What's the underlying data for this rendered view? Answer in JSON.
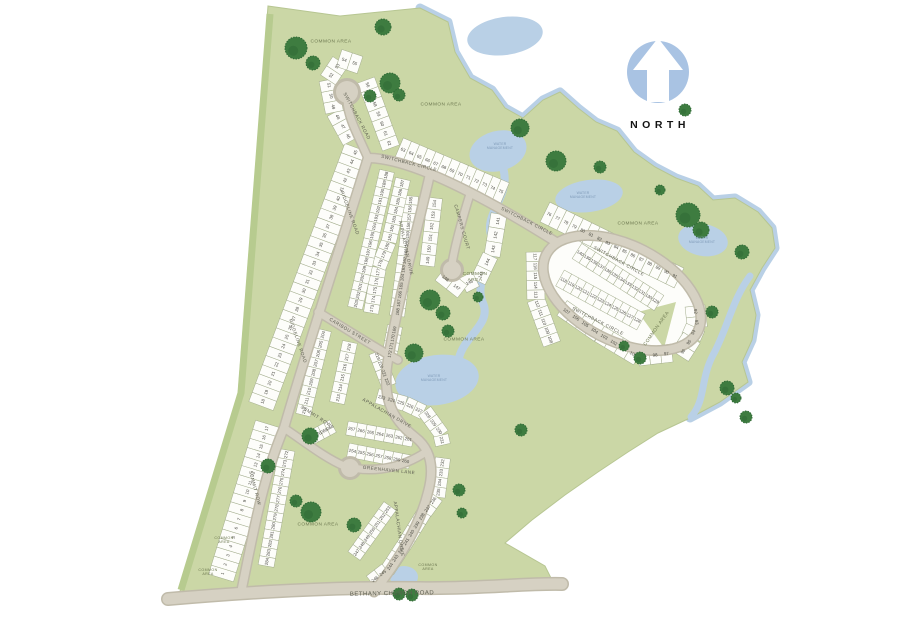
{
  "north_indicator": {
    "label": "NORTH"
  },
  "colors": {
    "site_green": "#cbd7a6",
    "site_green_dark": "#b7cb8f",
    "tree_green": "#3e7c40",
    "tree_green_dark": "#2f6a35",
    "water_blue": "#b9d0e6",
    "road_fill": "#d6d1c3",
    "road_casing": "#c0bbaa",
    "lot_fill": "#fdfdfa",
    "lot_outline": "#a3ad8d",
    "lot_number_grey": "#4a4a42",
    "street_label_grey": "#5c5d50",
    "area_label_green": "#6d7850",
    "water_label_blue": "#7f9ab8",
    "north_blue": "#a9c3e3"
  },
  "map_labels": {
    "street_labels": [
      {
        "text": "SWITCHBACK ROAD",
        "x": 357,
        "y": 116,
        "rot": 62
      },
      {
        "text": "SWITCHBACK CIRCLE",
        "x": 409,
        "y": 163,
        "rot": 14
      },
      {
        "text": "SWITCHBACK CIRCLE",
        "x": 527,
        "y": 221,
        "rot": 27
      },
      {
        "text": "SWITCHBACK CIRCLE",
        "x": 619,
        "y": 261,
        "rot": 29
      },
      {
        "text": "SWITCHBACK CIRCLE",
        "x": 598,
        "y": 321,
        "rot": 27
      },
      {
        "text": "CAMPERS COURT",
        "x": 462,
        "y": 227,
        "rot": 74
      },
      {
        "text": "RIDGELINE ROAD",
        "x": 350,
        "y": 213,
        "rot": 70
      },
      {
        "text": "RIDGELINE ROAD",
        "x": 298,
        "y": 341,
        "rot": 71
      },
      {
        "text": "APPALACHIAN DRIVE",
        "x": 406,
        "y": 248,
        "rot": 78
      },
      {
        "text": "APPALACHIAN DRIVE",
        "x": 387,
        "y": 413,
        "rot": 30
      },
      {
        "text": "APPALACHIAN DRIVE",
        "x": 399,
        "y": 529,
        "rot": 82
      },
      {
        "text": "CARIBOU STREET",
        "x": 350,
        "y": 331,
        "rot": 31
      },
      {
        "text": "SUMMIT ROW",
        "x": 316,
        "y": 416,
        "rot": 33
      },
      {
        "text": "SUMMIT ROW",
        "x": 255,
        "y": 488,
        "rot": 75
      },
      {
        "text": "GREENHAVEN LANE",
        "x": 389,
        "y": 470,
        "rot": 6
      },
      {
        "text": "BETHANY CHURCH ROAD",
        "x": 392,
        "y": 594,
        "rot": -1,
        "size": 6
      }
    ],
    "area_labels": [
      {
        "text": "COMMON AREA",
        "x": 331,
        "y": 42
      },
      {
        "text": "COMMON AREA",
        "x": 441,
        "y": 105
      },
      {
        "text": "COMMON AREA",
        "x": 638,
        "y": 224
      },
      {
        "text": "COMMON AREA",
        "x": 475,
        "y": 277,
        "two_line": true
      },
      {
        "text": "COMMON AREA",
        "x": 464,
        "y": 340
      },
      {
        "text": "COMMON AREA",
        "x": 657,
        "y": 329,
        "rot": -55
      },
      {
        "text": "COMMON AREA",
        "x": 318,
        "y": 525
      },
      {
        "text": "COMMON AREA",
        "x": 224,
        "y": 540,
        "two_line": true,
        "tiny": true
      },
      {
        "text": "COMMON AREA",
        "x": 208,
        "y": 572,
        "two_line": true,
        "tiny": true
      },
      {
        "text": "COMMON AREA",
        "x": 428,
        "y": 567,
        "two_line": true,
        "tiny": true
      }
    ],
    "water_labels": [
      {
        "text": "WATER MANAGEMENT",
        "x": 500,
        "y": 146
      },
      {
        "text": "WATER MANAGEMENT",
        "x": 583,
        "y": 195
      },
      {
        "text": "WATER MANAGEMENT",
        "x": 434,
        "y": 378
      },
      {
        "text": "WATER MANAGEMENT",
        "x": 702,
        "y": 240
      }
    ]
  },
  "lots": {
    "strips": [
      {
        "name": "lots-1-17",
        "start": 1,
        "end": 17,
        "depth": 26,
        "path": [
          [
            221,
            578
          ],
          [
            268,
            424
          ]
        ]
      },
      {
        "name": "lots-18-45",
        "start": 18,
        "end": 45,
        "depth": 26,
        "path": [
          [
            261,
            406
          ],
          [
            357,
            148
          ]
        ]
      },
      {
        "name": "lots-46-55",
        "start": 46,
        "end": 55,
        "depth": 18,
        "path": [
          [
            351,
            141
          ],
          [
            334,
            110
          ],
          [
            328,
            80
          ],
          [
            342,
            59
          ],
          [
            360,
            65
          ]
        ]
      },
      {
        "name": "lots-56-62",
        "start": 56,
        "end": 62,
        "depth": 18,
        "path": [
          [
            366,
            80
          ],
          [
            391,
            148
          ]
        ]
      },
      {
        "name": "lots-63-75",
        "start": 63,
        "end": 75,
        "depth": 22,
        "path": [
          [
            399,
            148
          ],
          [
            505,
            193
          ]
        ]
      },
      {
        "name": "lots-76-91",
        "start": 76,
        "end": 91,
        "depth": 22,
        "path": [
          [
            545,
            212
          ],
          [
            679,
            278
          ]
        ]
      },
      {
        "name": "lots-92-96",
        "start": 92,
        "end": 96,
        "depth": 20,
        "path": [
          [
            695,
            306
          ],
          [
            697,
            324
          ],
          [
            689,
            342
          ],
          [
            680,
            356
          ]
        ]
      },
      {
        "name": "lots-97-107",
        "start": 97,
        "end": 107,
        "depth": 18,
        "path": [
          [
            672,
            353
          ],
          [
            638,
            357
          ],
          [
            598,
            333
          ],
          [
            562,
            308
          ]
        ]
      },
      {
        "name": "lots-108-117",
        "start": 108,
        "end": 117,
        "depth": 18,
        "path": [
          [
            552,
            344
          ],
          [
            536,
            300
          ],
          [
            535,
            252
          ]
        ]
      },
      {
        "name": "lots-118-128",
        "start": 118,
        "end": 128,
        "depth": 18,
        "path": [
          [
            560,
            278
          ],
          [
            641,
            322
          ]
        ]
      },
      {
        "name": "lots-129-140",
        "start": 129,
        "end": 140,
        "depth": 18,
        "path": [
          [
            659,
            303
          ],
          [
            577,
            251
          ]
        ]
      },
      {
        "name": "lots-141-148",
        "start": 141,
        "end": 148,
        "depth": 16,
        "path": [
          [
            499,
            214
          ],
          [
            493,
            250
          ],
          [
            480,
            277
          ],
          [
            458,
            288
          ],
          [
            440,
            274
          ]
        ]
      },
      {
        "name": "lots-149-154",
        "start": 149,
        "end": 154,
        "depth": 15,
        "path": [
          [
            427,
            266
          ],
          [
            435,
            198
          ]
        ]
      },
      {
        "name": "lots-155-168",
        "start": 155,
        "end": 168,
        "depth": 15,
        "path": [
          [
            411,
            196
          ],
          [
            407,
            242
          ],
          [
            397,
            316
          ]
        ]
      },
      {
        "name": "lots-169-172",
        "start": 169,
        "end": 172,
        "depth": 15,
        "path": [
          [
            395,
            326
          ],
          [
            389,
            358
          ]
        ]
      },
      {
        "name": "lots-173-187",
        "start": 173,
        "end": 187,
        "depth": 15,
        "path": [
          [
            371,
            313
          ],
          [
            379,
            266
          ],
          [
            389,
            241
          ],
          [
            403,
            179
          ]
        ]
      },
      {
        "name": "lots-188-203",
        "start": 188,
        "end": 203,
        "depth": 15,
        "path": [
          [
            387,
            171
          ],
          [
            371,
            240
          ],
          [
            355,
            308
          ]
        ]
      },
      {
        "name": "lots-204-212",
        "start": 204,
        "end": 212,
        "depth": 15,
        "path": [
          [
            324,
            330
          ],
          [
            303,
            415
          ]
        ]
      },
      {
        "name": "lots-213-218",
        "start": 213,
        "end": 218,
        "depth": 15,
        "path": [
          [
            337,
            403
          ],
          [
            350,
            342
          ]
        ]
      },
      {
        "name": "lots-219-222",
        "start": 219,
        "end": 222,
        "depth": 15,
        "path": [
          [
            376,
            352
          ],
          [
            389,
            386
          ]
        ]
      },
      {
        "name": "lots-223-231",
        "start": 223,
        "end": 231,
        "depth": 15,
        "path": [
          [
            377,
            396
          ],
          [
            406,
            404
          ],
          [
            427,
            414
          ],
          [
            440,
            432
          ],
          [
            443,
            445
          ]
        ]
      },
      {
        "name": "lots-232-246",
        "start": 232,
        "end": 246,
        "depth": 15,
        "path": [
          [
            443,
            458
          ],
          [
            438,
            494
          ],
          [
            422,
            516
          ],
          [
            406,
            542
          ],
          [
            389,
            568
          ],
          [
            371,
            582
          ]
        ]
      },
      {
        "name": "lots-247-253",
        "start": 247,
        "end": 253,
        "depth": 15,
        "path": [
          [
            354,
            556
          ],
          [
            390,
            506
          ]
        ]
      },
      {
        "name": "lots-254-260",
        "start": 254,
        "end": 260,
        "depth": 14,
        "path": [
          [
            348,
            450
          ],
          [
            410,
            462
          ]
        ]
      },
      {
        "name": "lots-261-267",
        "start": 261,
        "end": 267,
        "depth": 14,
        "path": [
          [
            413,
            440
          ],
          [
            347,
            428
          ]
        ]
      },
      {
        "name": "lots-268-271",
        "start": 268,
        "end": 271,
        "depth": 14,
        "path": [
          [
            333,
            426
          ],
          [
            309,
            439
          ]
        ]
      },
      {
        "name": "lots-272-284",
        "start": 272,
        "end": 284,
        "depth": 16,
        "path": [
          [
            287,
            450
          ],
          [
            266,
            566
          ]
        ]
      }
    ]
  }
}
